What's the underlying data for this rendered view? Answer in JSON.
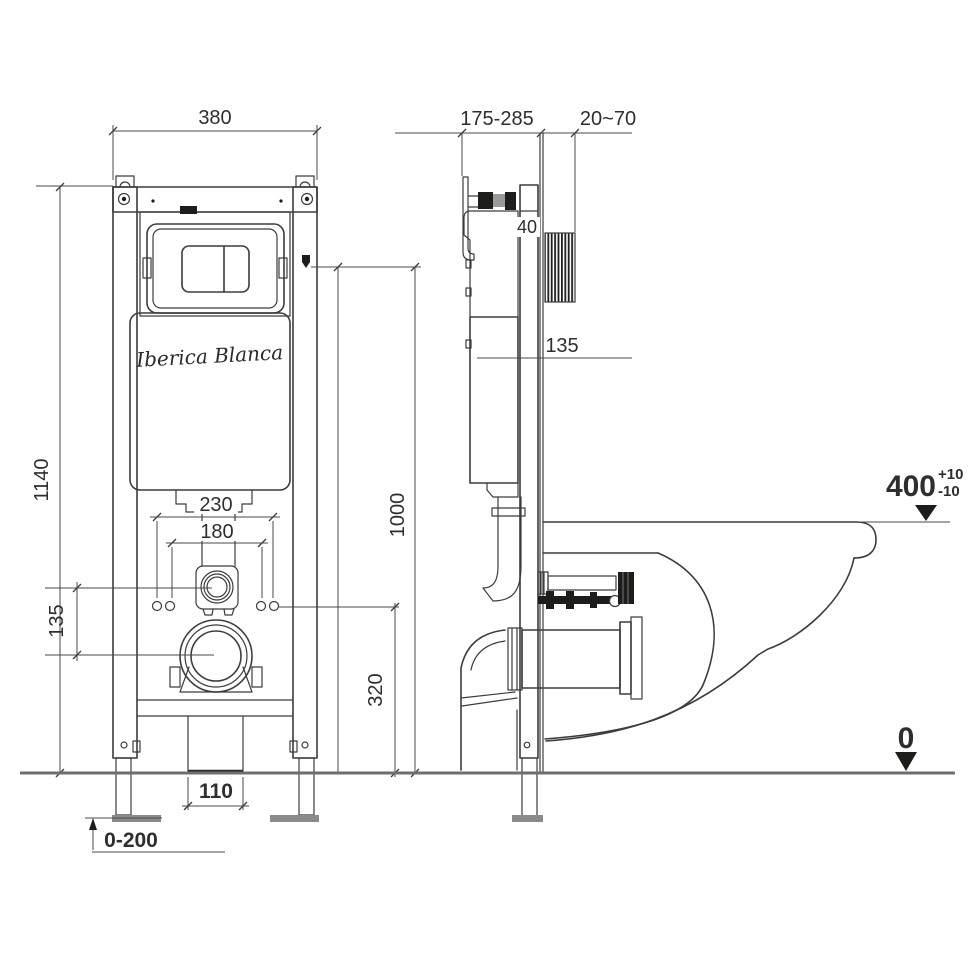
{
  "brand": {
    "name": "Iberica Blanca"
  },
  "front_view": {
    "frame_width": "380",
    "frame_height": "1140",
    "fixing_spacing_outer": "230",
    "fixing_spacing_inner": "180",
    "pipe_center_offset": "135",
    "supply_connection_height": "1000",
    "outlet_center_height": "320",
    "drain_opening_width": "110",
    "leg_adjust_range": "0-200"
  },
  "side_view": {
    "frame_depth_range": "175-285",
    "finished_wall_range": "20~70",
    "profile_depth": "40",
    "cistern_offset": "135",
    "bowl_rim_height": "400",
    "bowl_rim_tol_plus": "+10",
    "bowl_rim_tol_minus": "-10",
    "floor_datum": "0"
  }
}
